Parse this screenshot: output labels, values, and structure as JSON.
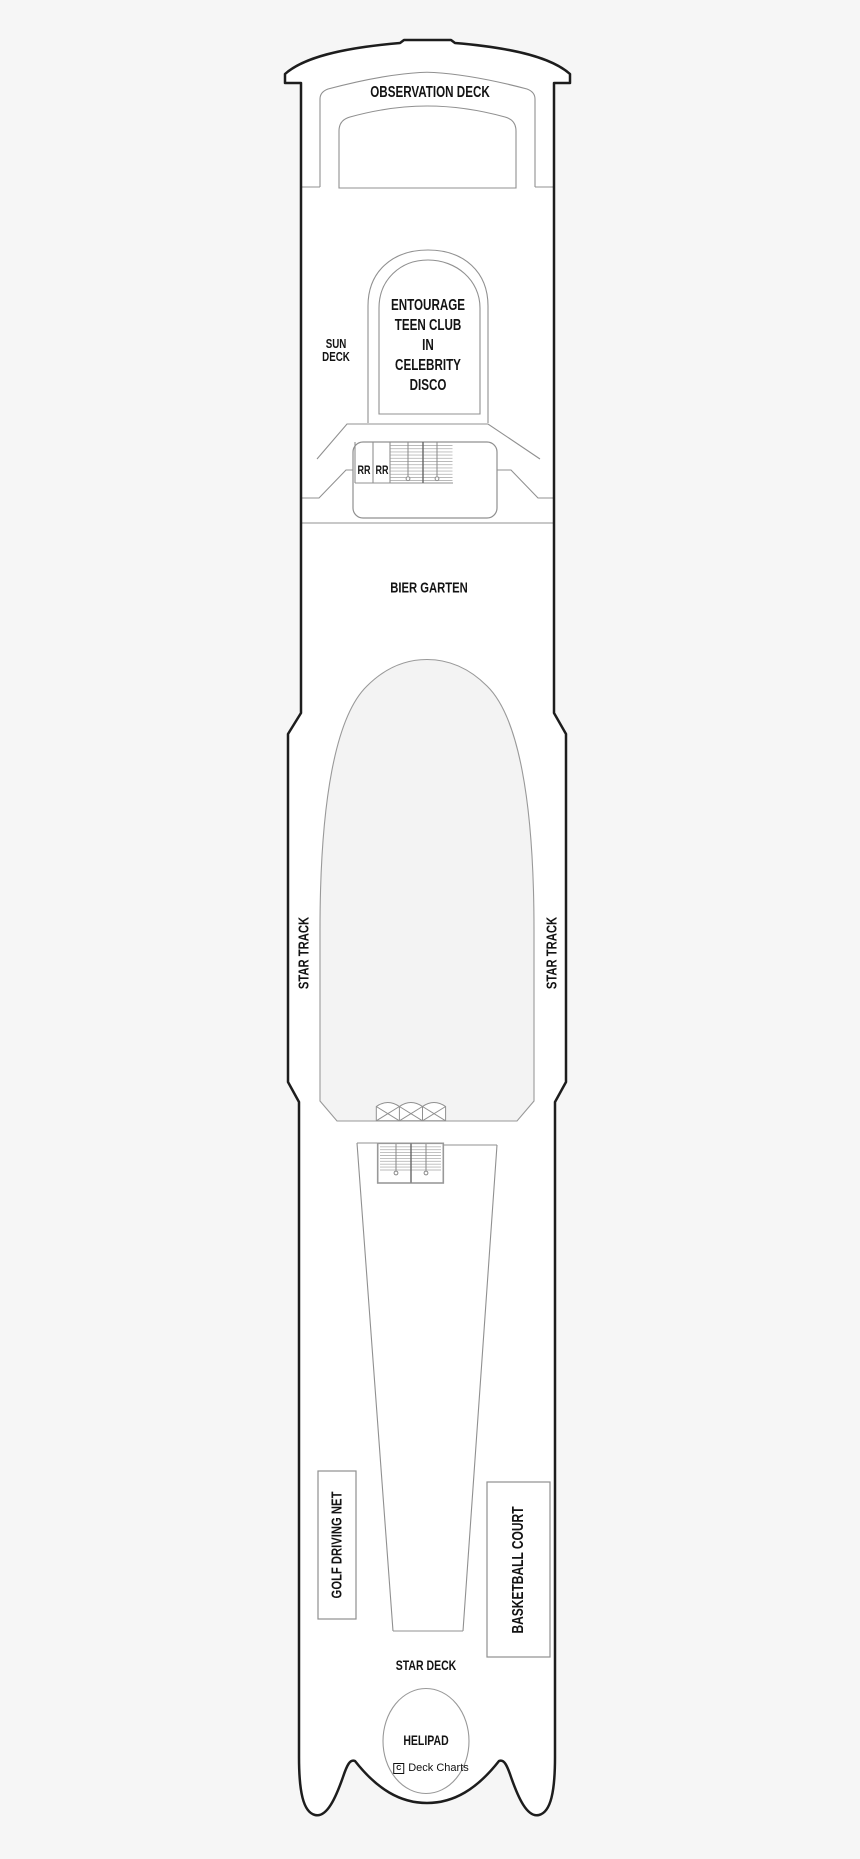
{
  "canvas": {
    "width": 860,
    "height": 1859,
    "background": "#f6f6f6"
  },
  "colors": {
    "ship_fill": "#ffffff",
    "hull_outline": "#1d1d1d",
    "detail_line": "#909090",
    "step_line": "#b9b9b9",
    "pool_fill": "#f3f3f3",
    "text": "#131313"
  },
  "deck_plan": {
    "areas": {
      "observation_deck": "OBSERVATION DECK",
      "sun_deck": "SUN\nDECK",
      "teen_club": "ENTOURAGE\nTEEN CLUB\nIN\nCELEBRITY\nDISCO",
      "restroom_left": "RR",
      "restroom_right": "RR",
      "bier_garten": "BIER GARTEN",
      "star_track_port": "STAR TRACK",
      "star_track_starboard": "STAR TRACK",
      "golf_driving_net": "GOLF DRIVING NET",
      "basketball_court": "BASKETBALL COURT",
      "star_deck": "STAR DECK",
      "helipad": "HELIPAD"
    },
    "credit": {
      "mark": "C",
      "name": "Deck Charts"
    }
  }
}
